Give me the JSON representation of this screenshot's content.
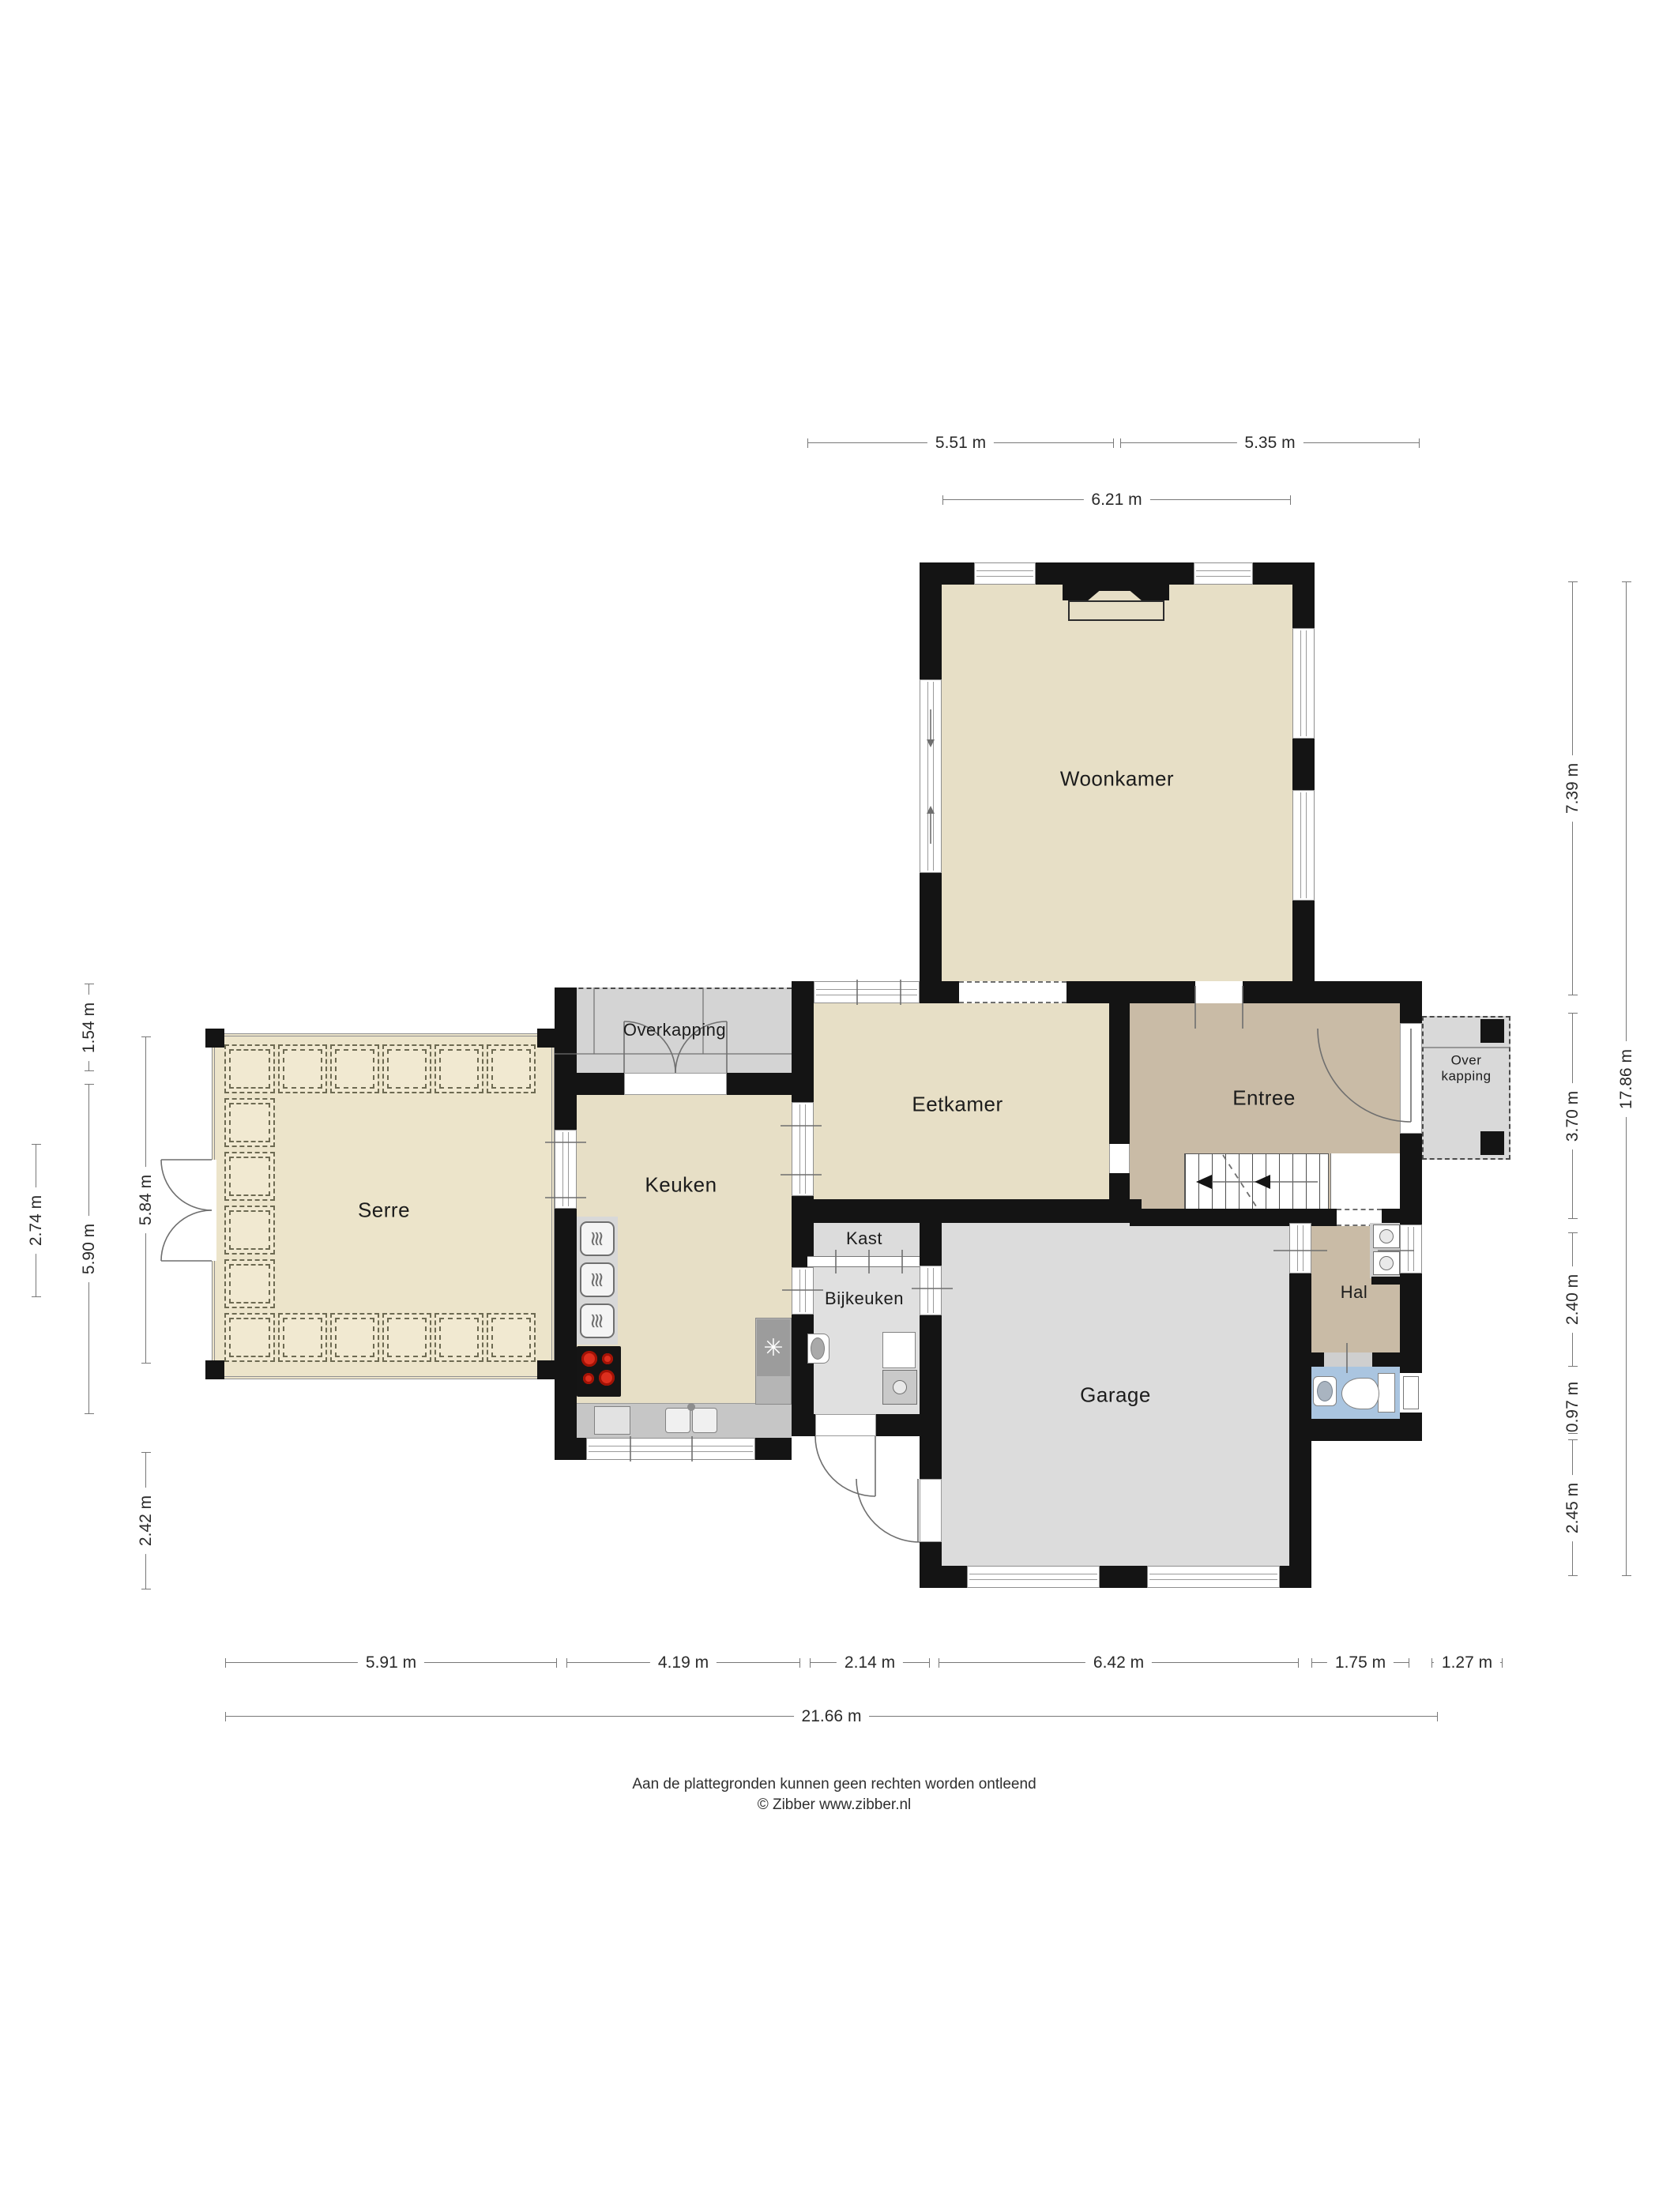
{
  "rooms": {
    "woonkamer": {
      "label": "Woonkamer"
    },
    "eetkamer": {
      "label": "Eetkamer"
    },
    "entree": {
      "label": "Entree"
    },
    "serre": {
      "label": "Serre"
    },
    "keuken": {
      "label": "Keuken"
    },
    "kast": {
      "label": "Kast"
    },
    "bijkeuken": {
      "label": "Bijkeuken"
    },
    "garage": {
      "label": "Garage"
    },
    "hal": {
      "label": "Hal"
    },
    "overkapping_top": {
      "label": "Overkapping"
    },
    "overkapping_right": {
      "label_line1": "Over",
      "label_line2": "kapping"
    }
  },
  "dimensions": {
    "top": [
      {
        "label": "5.51 m"
      },
      {
        "label": "5.35 m"
      },
      {
        "label": "6.21 m"
      }
    ],
    "right": [
      {
        "label": "7.39 m"
      },
      {
        "label": "3.70 m"
      },
      {
        "label": "2.40 m"
      },
      {
        "label": "0.97 m"
      },
      {
        "label": "2.45 m"
      },
      {
        "label": "17.86 m"
      }
    ],
    "left": [
      {
        "label": "1.54 m"
      },
      {
        "label": "5.90 m"
      },
      {
        "label": "2.74 m"
      },
      {
        "label": "5.84 m"
      },
      {
        "label": "2.42 m"
      }
    ],
    "bottom": [
      {
        "label": "5.91 m"
      },
      {
        "label": "4.19 m"
      },
      {
        "label": "2.14 m"
      },
      {
        "label": "6.42 m"
      },
      {
        "label": "1.75 m"
      },
      {
        "label": "1.27 m"
      },
      {
        "label": "21.66 m"
      }
    ]
  },
  "icons": {
    "fridge_fan_icon": "✳",
    "oven_steam_icon": "≋"
  },
  "colors": {
    "wall": "#141414",
    "floor_living": "#e7dfc6",
    "floor_hall": "#c9bba6",
    "floor_utility": "#dfdfdf",
    "floor_toilet": "#aac5e0",
    "floor_serre": "#ece4ca",
    "canopy_gray": "#d4d4d4",
    "burner_red": "#dd2f1e"
  },
  "footer": {
    "disclaimer": "Aan de plattegronden kunnen geen rechten worden ontleend",
    "copyright": "© Zibber www.zibber.nl"
  }
}
